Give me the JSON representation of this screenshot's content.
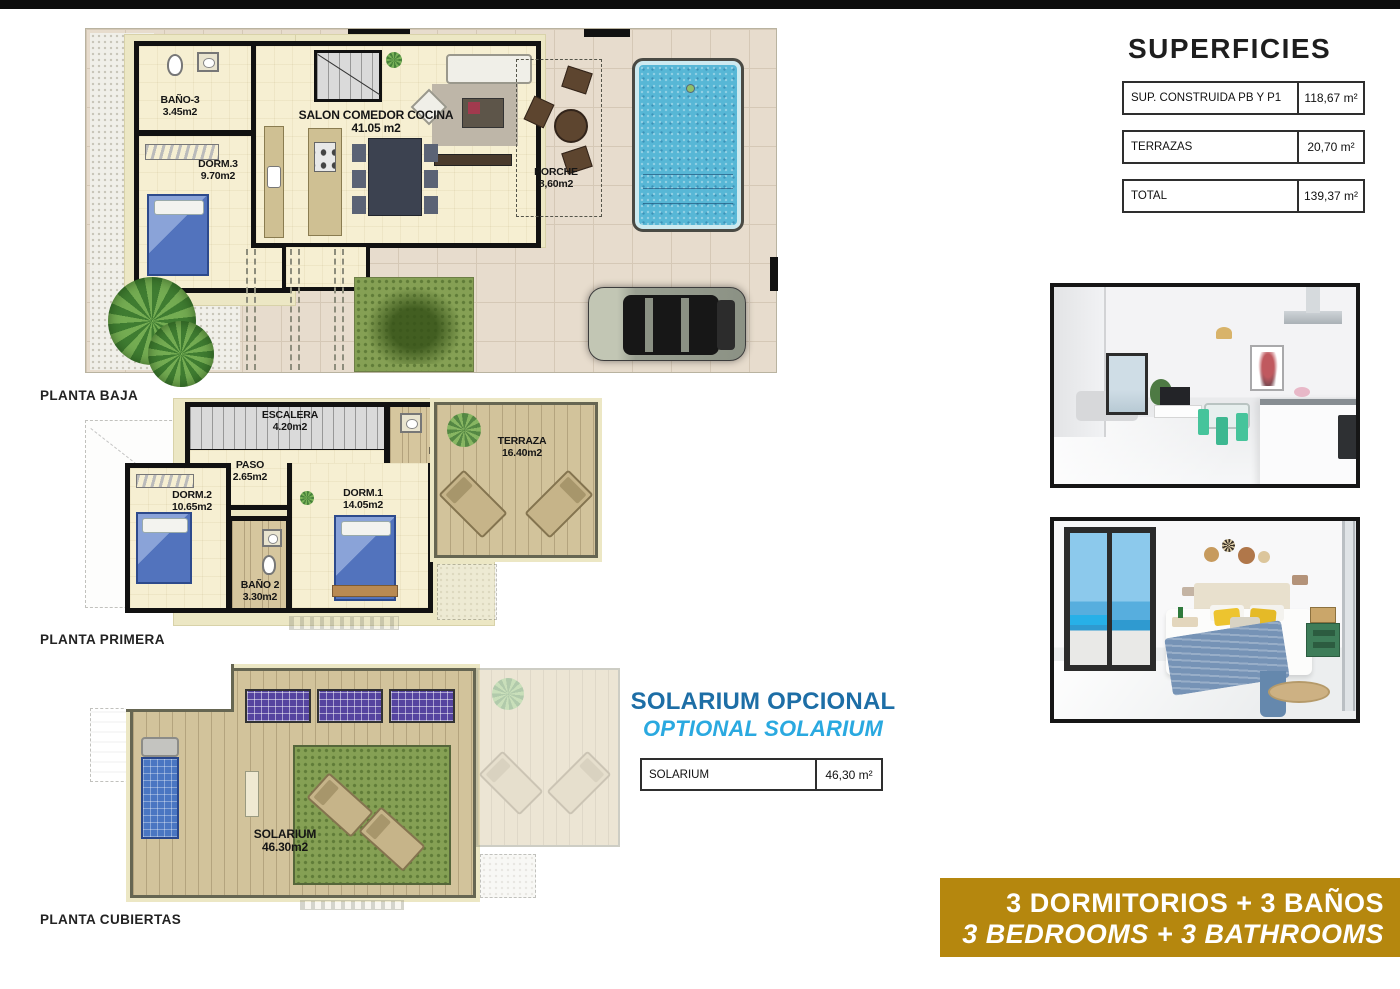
{
  "floors": {
    "baja": {
      "title": "PLANTA BAJA",
      "rooms": {
        "bano3": {
          "name": "BAÑO-3",
          "area": "3.45m2"
        },
        "dorm3": {
          "name": "DORM.3",
          "area": "9.70m2"
        },
        "salon": {
          "name": "SALON COMEDOR COCINA",
          "area": "41.05 m2"
        },
        "porche": {
          "name": "PORCHE",
          "area": "8,60m2"
        }
      }
    },
    "primera": {
      "title": "PLANTA PRIMERA",
      "rooms": {
        "escalera": {
          "name": "ESCALERA",
          "area": "4.20m2"
        },
        "paso": {
          "name": "PASO",
          "area": "2.65m2"
        },
        "bano1": {
          "name": "BAÑO 1",
          "area": "3.45m2"
        },
        "terraza": {
          "name": "TERRAZA",
          "area": "16.40m2"
        },
        "dorm2": {
          "name": "DORM.2",
          "area": "10.65m2"
        },
        "dorm1": {
          "name": "DORM.1",
          "area": "14.05m2"
        },
        "bano2": {
          "name": "BAÑO 2",
          "area": "3.30m2"
        }
      }
    },
    "cubiertas": {
      "title": "PLANTA CUBIERTAS",
      "rooms": {
        "solarium": {
          "name": "SOLARIUM",
          "area": "46.30m2"
        }
      }
    }
  },
  "superficies": {
    "title": "SUPERFICIES",
    "rows": [
      {
        "label": "SUP. CONSTRUIDA PB Y P1",
        "value": "118,67 m²"
      },
      {
        "label": "TERRAZAS",
        "value": "20,70 m²"
      },
      {
        "label": "TOTAL",
        "value": "139,37 m²"
      }
    ]
  },
  "solarium_section": {
    "title_es": "SOLARIUM OPCIONAL",
    "title_en": "OPTIONAL SOLARIUM",
    "row": {
      "label": "SOLARIUM",
      "value": "46,30 m²"
    }
  },
  "banner": {
    "line1": "3 DORMITORIOS + 3 BAÑOS",
    "line2": "3 BEDROOMS + 3 BATHROOMS"
  },
  "colors": {
    "accent_blue_dark": "#1d6ea6",
    "accent_blue_light": "#2aa9e0",
    "banner_gold": "#b5870e",
    "pool_blue": "#57b7d6"
  }
}
